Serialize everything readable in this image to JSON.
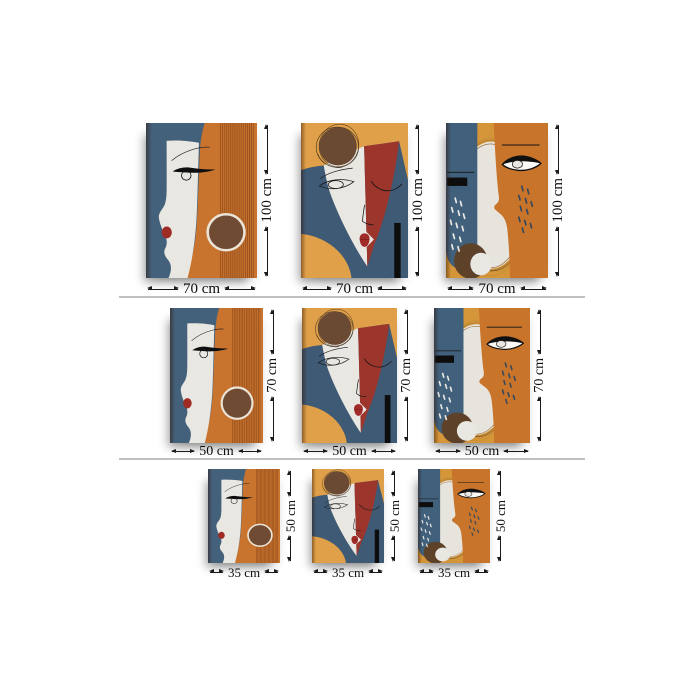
{
  "page": {
    "background": "#ffffff",
    "divider_color": "#c0c0c0",
    "arrow_color": "#1a1a1a"
  },
  "rows": [
    {
      "id": "size-100x70",
      "height_label": "100 cm",
      "width_label": "70 cm"
    },
    {
      "id": "size-70x50",
      "height_label": "70 cm",
      "width_label": "50 cm"
    },
    {
      "id": "size-50x35",
      "height_label": "50 cm",
      "width_label": "35 cm"
    }
  ],
  "artworks": [
    {
      "id": "artwork-profile-woman",
      "colors": {
        "background_blue": "#44617b",
        "hair_orange": "#c8742f",
        "stripe_dark": "#8a4719",
        "face_white": "#e9e7e2",
        "circle_brown": "#6f4b33",
        "circle_ring": "#ece4d6",
        "lips_red": "#9e2b24"
      }
    },
    {
      "id": "artwork-split-face",
      "colors": {
        "background_gold": "#dfa049",
        "blue": "#3f5a75",
        "red": "#9c352b",
        "face_white": "#e9e7e2",
        "sun_brown": "#6b4a33",
        "bar_black": "#0d0d0d",
        "lips_red": "#a02b28"
      }
    },
    {
      "id": "artwork-two-faces",
      "colors": {
        "background_gold": "#d59539",
        "left_face_blue": "#40607c",
        "right_face_orange": "#c9742b",
        "moon_white": "#e7e4dd",
        "blob_brown": "#5d4129",
        "tears_white": "#eceae4",
        "tears_blue": "#34485c"
      }
    }
  ]
}
